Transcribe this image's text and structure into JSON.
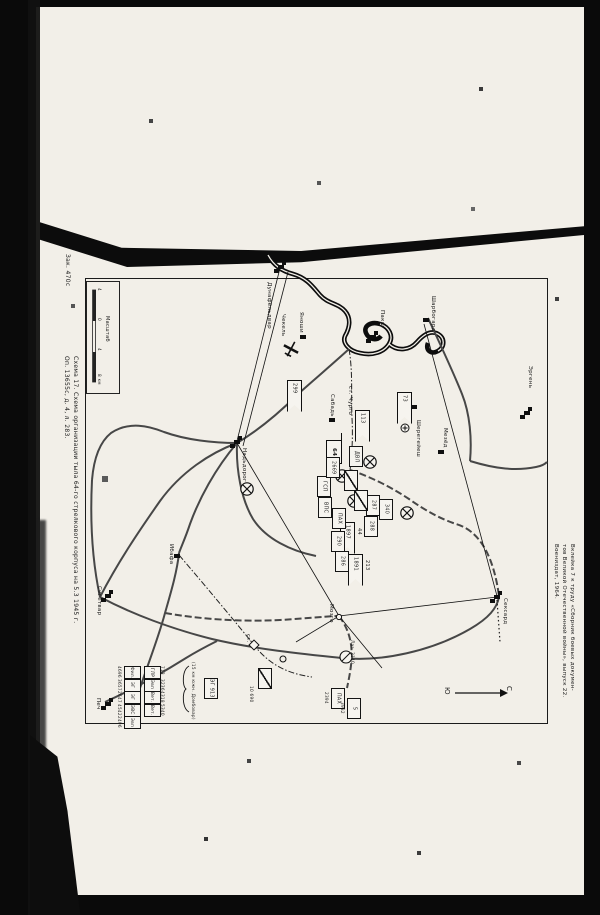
{
  "document": {
    "zak_number": "Зак. 470с",
    "caption": "Схема 17. Схема организации тыла 64-го стрелкового корпуса на 5.3 1945 г.",
    "archive_ref": "Оп. 13655с, д. 4, л. 283.",
    "source_note_lines": [
      "Вклейка 7 к труду «Сборник боевых докумен-",
      "тов Великой Отечественной войны», выпуск 22.",
      "Воениздат, 1964."
    ]
  },
  "map": {
    "scale": {
      "title": "Масштаб",
      "tick_labels": [
        "4",
        "0",
        "4",
        "8 км"
      ]
    },
    "compass": {
      "south_label": "Ю",
      "north_label": "С"
    },
    "towns": [
      {
        "label": "Дунафёльдвар",
        "x": 266,
        "y": 282,
        "bx": 281,
        "by": 267,
        "big": true
      },
      {
        "label": "Пакш",
        "x": 379,
        "y": 310,
        "bx": 373,
        "by": 337,
        "big": true
      },
      {
        "label": "Чекель",
        "x": 280,
        "y": 314
      },
      {
        "label": "Яноши",
        "x": 298,
        "y": 312,
        "bx": 303,
        "by": 337
      },
      {
        "label": "Надьдорог",
        "x": 241,
        "y": 448,
        "bx": 237,
        "by": 442,
        "big": true
      },
      {
        "label": "Сабадь",
        "x": 329,
        "y": 394,
        "bx": 332,
        "by": 420
      },
      {
        "label": "ст. Чурго",
        "x": 347,
        "y": 386
      },
      {
        "label": "Шарбогард",
        "x": 430,
        "y": 296,
        "bx": 426,
        "by": 320
      },
      {
        "label": "Шерегейеш",
        "x": 415,
        "y": 420,
        "bx": 414,
        "by": 407
      },
      {
        "label": "Мезёд",
        "x": 442,
        "y": 428,
        "bx": 441,
        "by": 452
      },
      {
        "label": "Эргень",
        "x": 527,
        "y": 366,
        "bx": 527,
        "by": 413,
        "big": true
      },
      {
        "label": "Ибафа",
        "x": 168,
        "y": 544,
        "bx": 177,
        "by": 556
      },
      {
        "label": "Сигетвар",
        "x": 96,
        "y": 586,
        "bx": 108,
        "by": 596,
        "big": true
      },
      {
        "label": "Печ",
        "x": 95,
        "y": 698,
        "bx": 108,
        "by": 704,
        "big": true
      },
      {
        "label": "Мозго",
        "x": 328,
        "y": 604,
        "bx": 339,
        "by": 617,
        "circle": true
      },
      {
        "label": "Сексард",
        "x": 502,
        "y": 598,
        "bx": 497,
        "by": 597,
        "big": true
      },
      {
        "label": "ст.",
        "x": 245,
        "y": 634
      }
    ],
    "pennant_flags": [
      {
        "number": "299",
        "x": 287,
        "y": 380
      },
      {
        "number": "113",
        "x": 355,
        "y": 410
      },
      {
        "number": "73",
        "x": 397,
        "y": 392
      },
      {
        "number": "1897",
        "side_number": "44",
        "x": 340,
        "y": 522
      },
      {
        "number": "1891",
        "side_number": "213",
        "x": 348,
        "y": 554
      }
    ],
    "hq_box": {
      "label": "64",
      "x": 326,
      "y": 440
    },
    "unit_boxes": [
      {
        "label": "ГСП",
        "x": 317,
        "y": 476
      },
      {
        "label": "ВПС",
        "x": 318,
        "y": 497
      },
      {
        "label": "2669",
        "x": 326,
        "y": 457
      },
      {
        "label": "ПАХ",
        "x": 332,
        "y": 508
      },
      {
        "label": "ДВЛ",
        "x": 349,
        "y": 446
      },
      {
        "label": "287",
        "x": 366,
        "y": 495
      },
      {
        "label": "288",
        "x": 364,
        "y": 516
      },
      {
        "label": "340",
        "x": 379,
        "y": 499
      },
      {
        "label": "290",
        "x": 331,
        "y": 531
      },
      {
        "label": "286",
        "x": 335,
        "y": 551
      },
      {
        "label": "",
        "x": 344,
        "y": 470,
        "diag": true
      },
      {
        "label": "",
        "x": 354,
        "y": 490,
        "diag": true
      },
      {
        "label": "",
        "x": 258,
        "y": 668,
        "diag": true
      },
      {
        "label": "ПАХ",
        "x": 331,
        "y": 688
      },
      {
        "label": "5",
        "x": 347,
        "y": 698
      }
    ],
    "misc_labels": [
      {
        "text": "Лаз. 2140",
        "x": 350,
        "y": 640
      },
      {
        "text": "10 690",
        "x": 249,
        "y": 686
      },
      {
        "text": "2394",
        "x": 324,
        "y": 692
      },
      {
        "text": "3982",
        "x": 340,
        "y": 702
      }
    ],
    "med_points": {
      "crossed": [
        [
          247,
          489
        ],
        [
          342,
          476
        ],
        [
          354,
          501
        ],
        [
          370,
          462
        ],
        [
          407,
          513
        ]
      ],
      "plus": [
        [
          405,
          428
        ]
      ],
      "plain": [
        [
          283,
          659
        ]
      ]
    },
    "hospital_block": {
      "col1": [
        {
          "abbr": "Фил.",
          "num": "4696"
        },
        {
          "abbr": "ЭГ",
          "num": "3657"
        },
        {
          "abbr": "ЭГ",
          "num": "2647"
        },
        {
          "abbr": "ЭВС",
          "num": "4542"
        },
        {
          "abbr": "Эвп",
          "num": "2496"
        }
      ],
      "col2": [
        {
          "abbr": "ГЛР",
          "num": "713"
        },
        {
          "abbr": "Эвп",
          "num": "3236"
        },
        {
          "abbr": "Вет.",
          "num": "4318"
        },
        {
          "abbr": "Вет.",
          "num": "5340"
        }
      ],
      "note": "(15 км южн. Домбовар)",
      "detached_label": "ЭГ 913"
    }
  }
}
